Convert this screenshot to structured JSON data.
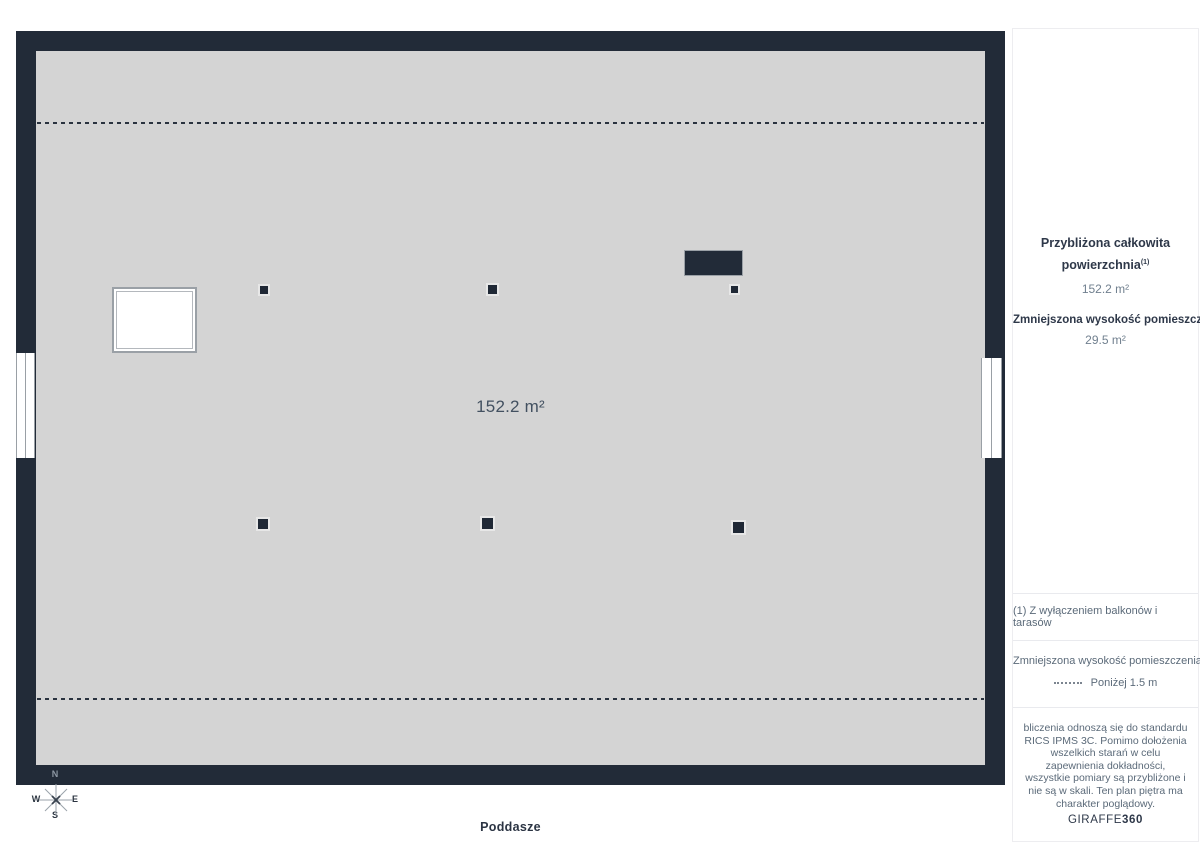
{
  "plan": {
    "room_area_label": "152.2 m²",
    "floor_label": "Poddasze"
  },
  "compass": {
    "n": "N",
    "w": "W",
    "e": "E",
    "s": "S"
  },
  "sidebar": {
    "summary": {
      "title": "Przybliżona całkowita powierzchnia",
      "title_sup": "(1)",
      "total_area": "152.2 m²",
      "reduced_heading": "Zmniejszona wysokość pomieszczenia",
      "reduced_area": "29.5 m²"
    },
    "footnote": "(1) Z wyłączeniem balkonów i tarasów",
    "legend": {
      "heading": "Zmniejszona wysokość pomieszczenia",
      "item_label": "Poniżej 1.5 m"
    },
    "disclaimer": "bliczenia odnoszą się do standardu RICS IPMS 3C. Pomimo dołożenia wszelkich starań w celu zapewnienia dokładności, wszystkie pomiary są przybliżone i nie są w skali. Ten plan piętra ma charakter poglądowy.",
    "logo": {
      "brand": "GIRAFFE",
      "suffix": "360"
    }
  },
  "colors": {
    "wall": "#222b38",
    "floor": "#d4d4d4",
    "accent_text": "#2e3849",
    "muted_text": "#71808f"
  }
}
